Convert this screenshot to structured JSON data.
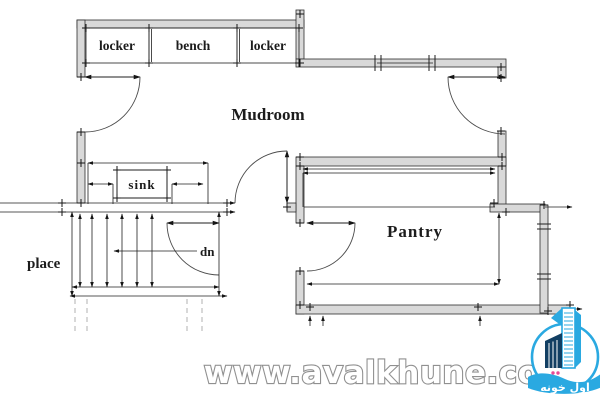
{
  "plan": {
    "labels": {
      "locker_left": "locker",
      "bench": "bench",
      "locker_right": "locker",
      "mudroom": "Mudroom",
      "pantry": "Pantry",
      "sink": "sink",
      "down": "dn",
      "fireplace_partial": "place"
    }
  },
  "watermark": {
    "url_text": "www.avalkhune.com"
  },
  "logo": {
    "brand_text": "اول خونه"
  },
  "colors": {
    "wall_fill": "#d9d9d9",
    "line": "#1f1f1f",
    "logo_blue": "#2aa9e1",
    "logo_navy": "#123f63",
    "logo_pink": "#e94a96",
    "logo_teal": "#16b3a4",
    "watermark_outline": "#909090"
  }
}
